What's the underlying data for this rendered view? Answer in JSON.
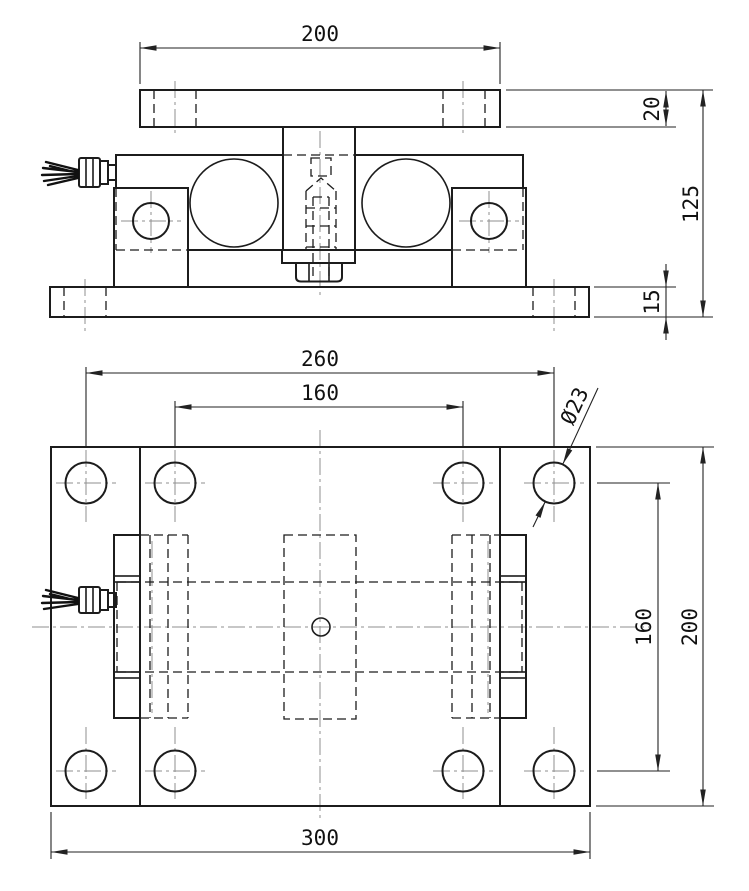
{
  "drawing": {
    "dimensions": {
      "top_plate_width": "200",
      "top_plate_thickness": "20",
      "overall_height": "125",
      "base_plate_thickness": "15",
      "outer_bolt_spacing": "260",
      "inner_bolt_spacing": "160",
      "hole_diameter": "Ø23",
      "row_spacing": "160",
      "plate_depth": "200",
      "base_plate_width": "300"
    },
    "colors": {
      "line": "#1c1c1c",
      "centerline": "#8f8f8f",
      "background": "#ffffff"
    }
  }
}
